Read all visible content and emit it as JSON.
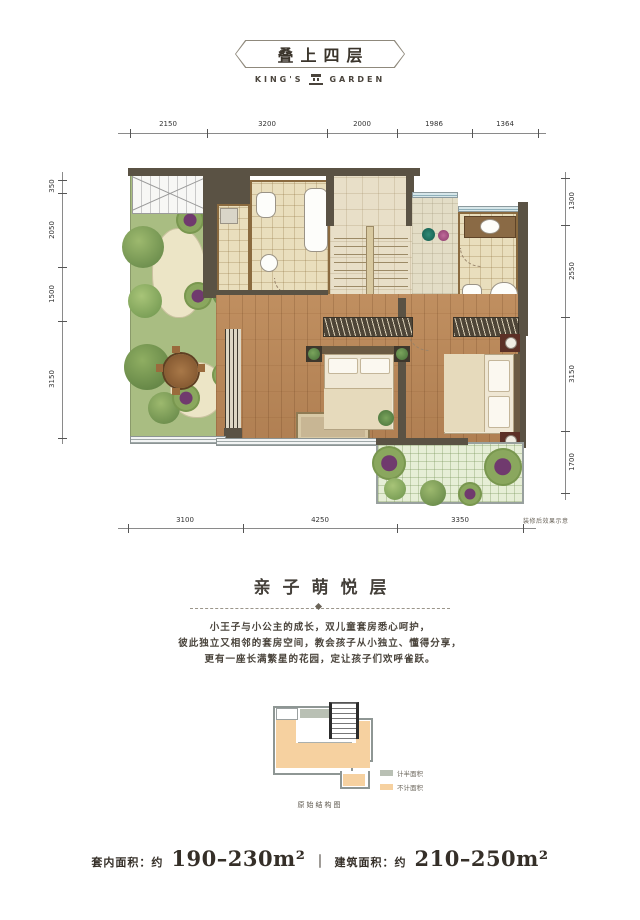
{
  "header": {
    "title": "叠上四层",
    "brand_left": "KING'S",
    "brand_right": "GARDEN"
  },
  "plan": {
    "dims_top": [
      "2150",
      "3200",
      "2000",
      "1986",
      "1364"
    ],
    "dims_left": [
      "350",
      "2050",
      "1500",
      "3150"
    ],
    "dims_right": [
      "1300",
      "2550",
      "3150",
      "1700"
    ],
    "dims_bottom": [
      "3100",
      "4250",
      "3350"
    ],
    "note": "装修后效果示意"
  },
  "section": {
    "title": "亲子萌悦层",
    "paragraph": [
      "小王子与小公主的成长，双儿童套房悉心呵护，",
      "彼此独立又相邻的套房空间，教会孩子从小独立、懂得分享，",
      "更有一座长满繁星的花园，定让孩子们欢呼雀跃。"
    ]
  },
  "inset": {
    "legend": [
      {
        "label": "计半面积",
        "color": "#b9c0b4"
      },
      {
        "label": "不计面积",
        "color": "#f6d1a0"
      }
    ],
    "caption": "原始结构图"
  },
  "footer": {
    "area1_label": "套内面积：约",
    "area1_value": "190–230m²",
    "divider": "｜",
    "area2_label": "建筑面积：约",
    "area2_value": "210–250m²"
  },
  "colors": {
    "wall": "#5a5244",
    "wood": "#b5835a",
    "garden": "#a9bd82",
    "tile": "#e9debd",
    "accent_orange": "#f6d1a0",
    "accent_gray": "#b9c0b4"
  }
}
